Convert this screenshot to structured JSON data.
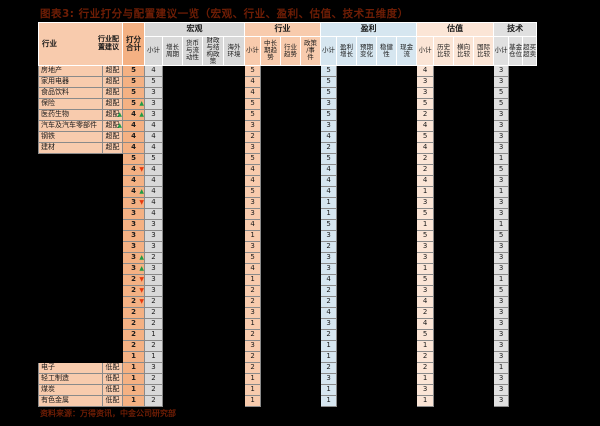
{
  "page": {
    "title": "图表3: 行业打分与配置建议一览（宏观、行业、盈利、估值、技术五维度）",
    "source": "资料来源：万得资讯，中金公司研究部"
  },
  "colors": {
    "page_bg": "#000000",
    "title_text": "#6e1d05",
    "header_peach": "#F8CBAD",
    "total_col": "#F4B183",
    "macro_bg": "#D9D9D9",
    "industry_bg": "#F8CBAD",
    "profit_bg": "#D6E6F0",
    "valuation_bg": "#FBE5D6",
    "technical_bg": "#E0E0E0",
    "arrow_up": "#1f9d45",
    "arrow_down": "#e83a0e"
  },
  "icons": {
    "up_arrow": "▲",
    "down_arrow": "▼"
  },
  "table": {
    "left_header": {
      "industry": "行业",
      "advice": "行业配\n置建议"
    },
    "score_header": "打分\n合计",
    "groups": [
      {
        "label": "宏观",
        "bg": "#D9D9D9",
        "cols": [
          "小计",
          "增长\n周期",
          "货币\n与流\n动性",
          "财政\n与结\n构政\n策",
          "海外\n环境"
        ]
      },
      {
        "label": "行业",
        "bg": "#F8CBAD",
        "cols": [
          "小计",
          "中长\n期趋\n势",
          "行业\n趋势",
          "政策\n/事\n件"
        ]
      },
      {
        "label": "盈利",
        "bg": "#D6E6F0",
        "cols": [
          "小计",
          "盈利\n增长",
          "预期\n变化",
          "稳健\n性",
          "现金\n流"
        ]
      },
      {
        "label": "估值",
        "bg": "#FBE5D6",
        "cols": [
          "小计",
          "历史\n比较",
          "横向\n比较",
          "国际\n比较"
        ]
      },
      {
        "label": "技术",
        "bg": "#E0E0E0",
        "cols": [
          "小计",
          "基金\n仓位",
          "超买\n超卖"
        ]
      }
    ],
    "rows": [
      {
        "name": "房地产",
        "advice": "超配",
        "adv_arrow": null,
        "total": 5,
        "t_arrow": null,
        "subs": [
          4,
          5,
          5,
          4,
          3
        ],
        "masked": false
      },
      {
        "name": "家用电器",
        "advice": "超配",
        "adv_arrow": null,
        "total": 5,
        "t_arrow": null,
        "subs": [
          5,
          4,
          5,
          3,
          3
        ],
        "masked": false
      },
      {
        "name": "食品饮料",
        "advice": "超配",
        "adv_arrow": null,
        "total": 5,
        "t_arrow": null,
        "subs": [
          3,
          4,
          5,
          3,
          5
        ],
        "masked": false
      },
      {
        "name": "保险",
        "advice": "超配",
        "adv_arrow": null,
        "total": 5,
        "t_arrow": "up",
        "subs": [
          3,
          5,
          3,
          5,
          5
        ],
        "masked": false
      },
      {
        "name": "医药生物",
        "advice": "超配",
        "adv_arrow": "up",
        "total": 4,
        "t_arrow": "up",
        "subs": [
          3,
          5,
          5,
          2,
          3
        ],
        "masked": false
      },
      {
        "name": "汽车及汽车零部件",
        "advice": "超配",
        "adv_arrow": "up",
        "total": 4,
        "t_arrow": null,
        "subs": [
          4,
          3,
          3,
          4,
          3
        ],
        "masked": false
      },
      {
        "name": "钢铁",
        "advice": "超配",
        "adv_arrow": null,
        "total": 4,
        "t_arrow": null,
        "subs": [
          4,
          2,
          4,
          5,
          3
        ],
        "masked": false
      },
      {
        "name": "建材",
        "advice": "超配",
        "adv_arrow": null,
        "total": 4,
        "t_arrow": null,
        "subs": [
          4,
          3,
          2,
          4,
          3
        ],
        "masked": false
      },
      {
        "name": "",
        "advice": "",
        "adv_arrow": null,
        "total": 5,
        "t_arrow": null,
        "subs": [
          5,
          5,
          5,
          2,
          1
        ],
        "masked": true
      },
      {
        "name": "",
        "advice": "",
        "adv_arrow": null,
        "total": 4,
        "t_arrow": "down",
        "subs": [
          4,
          4,
          4,
          2,
          5
        ],
        "masked": true
      },
      {
        "name": "",
        "advice": "",
        "adv_arrow": null,
        "total": 4,
        "t_arrow": null,
        "subs": [
          4,
          4,
          4,
          4,
          3
        ],
        "masked": true
      },
      {
        "name": "",
        "advice": "",
        "adv_arrow": null,
        "total": 4,
        "t_arrow": "up",
        "subs": [
          4,
          5,
          4,
          1,
          1
        ],
        "masked": true
      },
      {
        "name": "",
        "advice": "",
        "adv_arrow": null,
        "total": 3,
        "t_arrow": "down",
        "subs": [
          4,
          3,
          1,
          3,
          3
        ],
        "masked": true
      },
      {
        "name": "",
        "advice": "",
        "adv_arrow": null,
        "total": 3,
        "t_arrow": null,
        "subs": [
          4,
          3,
          1,
          5,
          3
        ],
        "masked": true
      },
      {
        "name": "",
        "advice": "",
        "adv_arrow": null,
        "total": 3,
        "t_arrow": null,
        "subs": [
          3,
          4,
          5,
          1,
          1
        ],
        "masked": true
      },
      {
        "name": "",
        "advice": "",
        "adv_arrow": null,
        "total": 3,
        "t_arrow": null,
        "subs": [
          3,
          1,
          3,
          5,
          5
        ],
        "masked": true
      },
      {
        "name": "",
        "advice": "",
        "adv_arrow": null,
        "total": 3,
        "t_arrow": null,
        "subs": [
          3,
          3,
          2,
          3,
          3
        ],
        "masked": true
      },
      {
        "name": "",
        "advice": "",
        "adv_arrow": null,
        "total": 3,
        "t_arrow": "up",
        "subs": [
          2,
          5,
          3,
          3,
          3
        ],
        "masked": true
      },
      {
        "name": "",
        "advice": "",
        "adv_arrow": null,
        "total": 3,
        "t_arrow": "up",
        "subs": [
          3,
          4,
          3,
          1,
          3
        ],
        "masked": true
      },
      {
        "name": "",
        "advice": "",
        "adv_arrow": null,
        "total": 2,
        "t_arrow": "down",
        "subs": [
          3,
          1,
          4,
          5,
          1
        ],
        "masked": true
      },
      {
        "name": "",
        "advice": "",
        "adv_arrow": null,
        "total": 2,
        "t_arrow": "down",
        "subs": [
          3,
          2,
          2,
          3,
          5
        ],
        "masked": true
      },
      {
        "name": "",
        "advice": "",
        "adv_arrow": null,
        "total": 2,
        "t_arrow": "down",
        "subs": [
          2,
          2,
          2,
          4,
          3
        ],
        "masked": true
      },
      {
        "name": "",
        "advice": "",
        "adv_arrow": null,
        "total": 2,
        "t_arrow": null,
        "subs": [
          2,
          3,
          4,
          2,
          3
        ],
        "masked": true
      },
      {
        "name": "",
        "advice": "",
        "adv_arrow": null,
        "total": 2,
        "t_arrow": null,
        "subs": [
          2,
          1,
          3,
          4,
          3
        ],
        "masked": true
      },
      {
        "name": "",
        "advice": "",
        "adv_arrow": null,
        "total": 2,
        "t_arrow": null,
        "subs": [
          1,
          2,
          2,
          5,
          3
        ],
        "masked": true
      },
      {
        "name": "",
        "advice": "",
        "adv_arrow": null,
        "total": 2,
        "t_arrow": null,
        "subs": [
          2,
          3,
          1,
          1,
          3
        ],
        "masked": true
      },
      {
        "name": "",
        "advice": "",
        "adv_arrow": null,
        "total": 1,
        "t_arrow": null,
        "subs": [
          1,
          2,
          1,
          2,
          3
        ],
        "masked": true
      },
      {
        "name": "电子",
        "advice": "低配",
        "adv_arrow": null,
        "total": 1,
        "t_arrow": null,
        "subs": [
          3,
          2,
          2,
          2,
          1
        ],
        "masked": false
      },
      {
        "name": "轻工制造",
        "advice": "低配",
        "adv_arrow": null,
        "total": 1,
        "t_arrow": null,
        "subs": [
          2,
          1,
          3,
          1,
          3
        ],
        "masked": false
      },
      {
        "name": "煤炭",
        "advice": "低配",
        "adv_arrow": null,
        "total": 1,
        "t_arrow": null,
        "subs": [
          2,
          1,
          1,
          3,
          3
        ],
        "masked": false
      },
      {
        "name": "有色金属",
        "advice": "低配",
        "adv_arrow": null,
        "total": 1,
        "t_arrow": null,
        "subs": [
          2,
          1,
          1,
          1,
          3
        ],
        "masked": false
      }
    ]
  }
}
